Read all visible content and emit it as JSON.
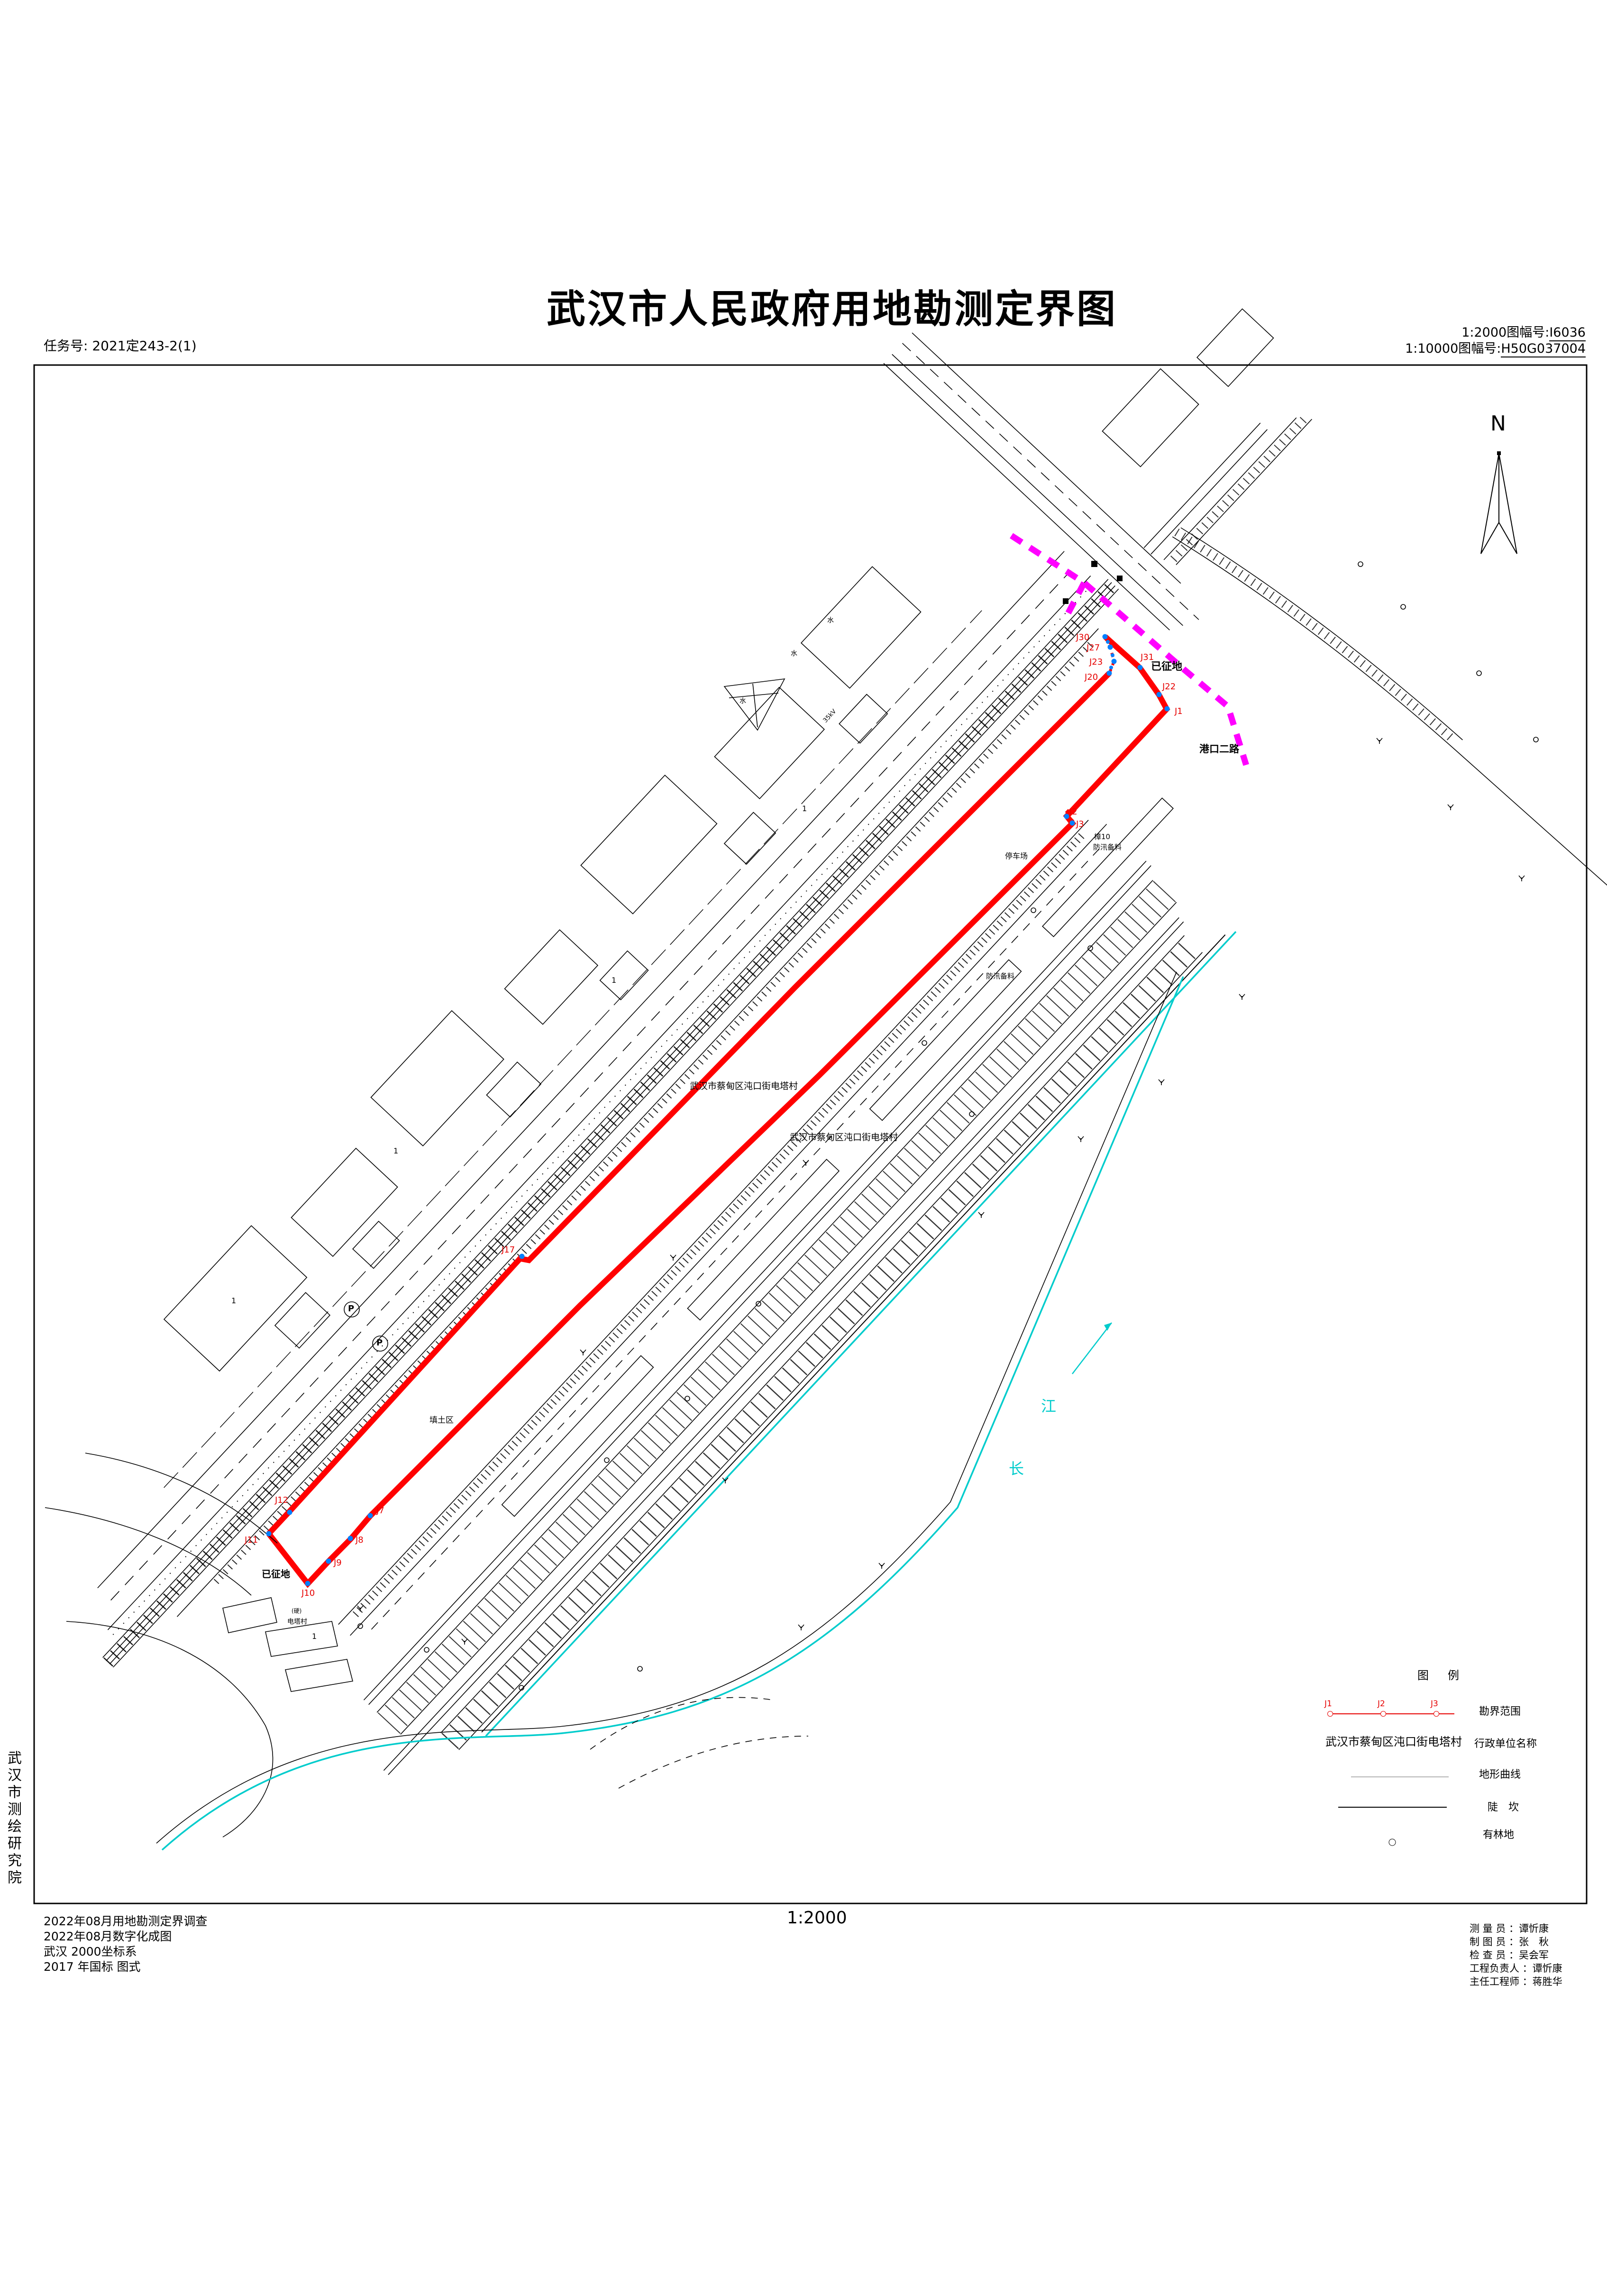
{
  "header": {
    "task_no": "任务号: 2021定243-2(1)",
    "title": "武汉市人民政府用地勘测定界图",
    "sheet_small_label": "1:2000图幅号:",
    "sheet_small_value": "I6036",
    "sheet_large_label": "1:10000图幅号:",
    "sheet_large_value": "H50G037004",
    "north": "N"
  },
  "institute": "武汉市测绘研究院",
  "map": {
    "labels": {
      "requisitioned_top": "已征地",
      "requisitioned_bottom": "已征地",
      "road_gangkou": "港口二路",
      "village_name_1": "武汉市蔡甸区沌口街电塔村",
      "village_name_2": "武汉市蔡甸区沌口街电塔村",
      "parking": "停车场",
      "camphor": "樟10",
      "flood_material_1": "防汛备料",
      "flood_material_2": "防汛备料",
      "fill_area": "填土区",
      "dianta_village": "电塔村",
      "hard_surface": "(硬)",
      "river_char_1": "长",
      "river_char_2": "江",
      "power_line": "35kV",
      "pond": "水",
      "plot_no": "1",
      "parking_p": "P"
    },
    "boundary_points": {
      "j1": "J1",
      "j2": "J2",
      "j3": "J3",
      "j7": "J7",
      "j8": "J8",
      "j9": "J9",
      "j10": "J10",
      "j11": "J11",
      "j12": "J12",
      "j17": "J17",
      "j20": "J20",
      "j22": "J22",
      "j23": "J23",
      "j27": "J27",
      "j30": "J30",
      "j31": "J31"
    },
    "colors": {
      "boundary_red": "#FF0000",
      "requisition_magenta": "#FF00FF",
      "water_cyan": "#00CCCC",
      "point_blue": "#0080FF"
    }
  },
  "legend": {
    "title": "图　例",
    "sample_points": [
      "J1",
      "J2",
      "J3"
    ],
    "rows": [
      {
        "label": "勘界范围"
      },
      {
        "sample": "武汉市蔡甸区沌口街电塔村",
        "label": "行政单位名称"
      },
      {
        "label": "地形曲线"
      },
      {
        "label": "陡　坎"
      },
      {
        "label": "有林地"
      }
    ]
  },
  "footer": {
    "notes": [
      "2022年08月用地勘测定界调查",
      "2022年08月数字化成图",
      "武汉 2000坐标系",
      "2017 年国标 图式"
    ],
    "scale": "1:2000",
    "credits": [
      "测 量 员 ：谭忻康",
      "制 图 员 ：张　秋",
      "检 查 员 ：吴会军",
      "工程负责人 ：谭忻康",
      "主任工程师 ：蒋胜华"
    ]
  }
}
